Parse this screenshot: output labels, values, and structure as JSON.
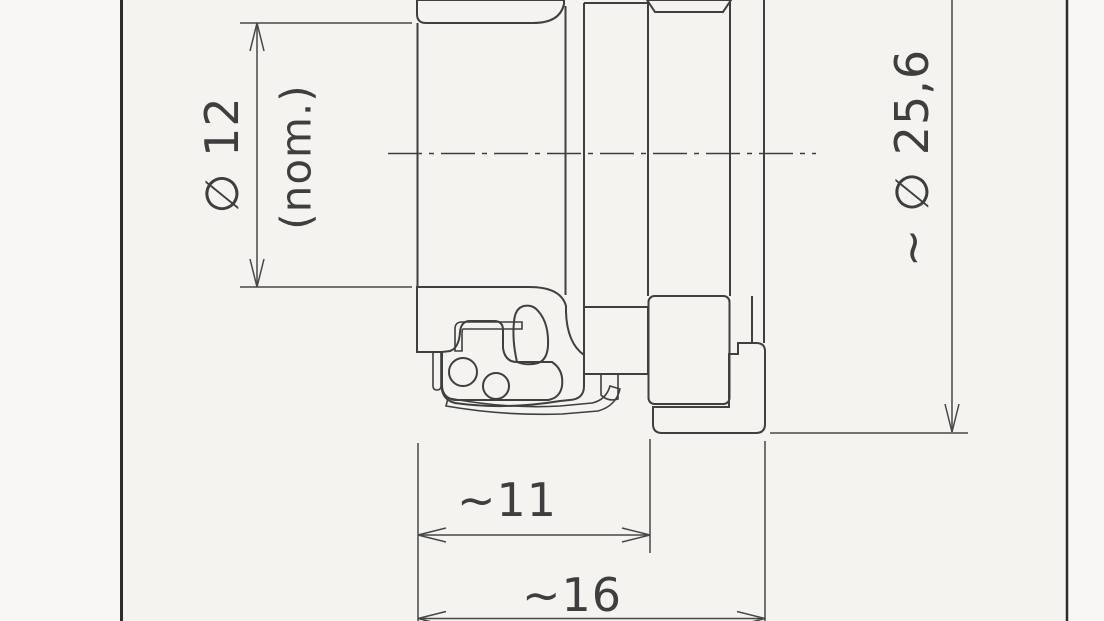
{
  "drawing": {
    "description": "Engineering cross-section drawing of a circular panel connector (flange, threaded coupling, knurled nut, rear body)",
    "dimensions": {
      "bore_diameter": {
        "label": "∅ 12",
        "qualifier": "(nom.)"
      },
      "outer_diameter": {
        "label": "~ ∅ 25,6"
      },
      "front_length": {
        "label": "~11"
      },
      "overall_length": {
        "label": "~16"
      }
    },
    "colors": {
      "paper": "#f4f3f0",
      "margin_paper": "#f8f7f5",
      "line": "#3f3f3f",
      "frame": "#2c2c2c"
    }
  }
}
